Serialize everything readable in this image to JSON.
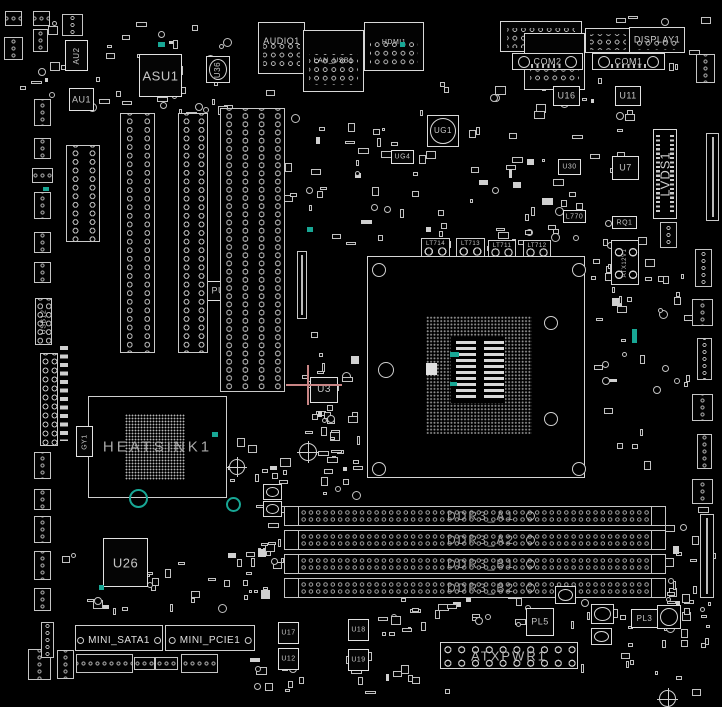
{
  "board": {
    "width": 722,
    "height": 707,
    "background": "#000000",
    "silkscreen_color": "#d6d6d6",
    "label_color": "#c4c4c4",
    "teal_accent": "#18a795",
    "crosshair_pink": "#c98585"
  },
  "components": [
    {
      "name": "audio1-connector",
      "label": "AUDIO1",
      "type": "io",
      "x": 258,
      "y": 22,
      "w": 47,
      "h": 52,
      "fs": 9,
      "labelTop": 14
    },
    {
      "name": "lan-usb1-connector",
      "label": "LAN_USB1",
      "type": "io",
      "x": 303,
      "y": 30,
      "w": 61,
      "h": 62,
      "fs": 7
    },
    {
      "name": "hdmi1-connector",
      "label": "HDMI1",
      "type": "io",
      "x": 364,
      "y": 22,
      "w": 60,
      "h": 49,
      "fs": 7,
      "labelTop": 16
    },
    {
      "name": "usb-stack-connector",
      "label": null,
      "type": "io",
      "x": 500,
      "y": 21,
      "w": 82,
      "h": 31
    },
    {
      "name": "lan-usb2-connector",
      "label": "LAN_USB2",
      "type": "io",
      "x": 524,
      "y": 33,
      "w": 61,
      "h": 57,
      "fs": 7
    },
    {
      "name": "io-connector-small",
      "label": null,
      "type": "io",
      "x": 585,
      "y": 28,
      "w": 46,
      "h": 25
    },
    {
      "name": "display1-connector",
      "label": "DISPLAY1",
      "type": "io",
      "x": 629,
      "y": 27,
      "w": 56,
      "h": 26,
      "fs": 9
    },
    {
      "name": "com2-port",
      "label": "COM2",
      "type": "com",
      "x": 512,
      "y": 53,
      "w": 71,
      "h": 17,
      "fs": 9
    },
    {
      "name": "com1-port",
      "label": "COM1",
      "type": "com",
      "x": 592,
      "y": 53,
      "w": 73,
      "h": 17,
      "fs": 9
    },
    {
      "name": "au2-chip",
      "label": "AU2",
      "type": "chip",
      "x": 65,
      "y": 40,
      "w": 23,
      "h": 31,
      "fs": 8,
      "vert": true
    },
    {
      "name": "asu1-chip",
      "label": "ASU1",
      "type": "chip",
      "x": 139,
      "y": 54,
      "w": 43,
      "h": 43,
      "fs": 13
    },
    {
      "name": "au1-chip",
      "label": "AU1",
      "type": "chip",
      "x": 69,
      "y": 88,
      "w": 25,
      "h": 23,
      "fs": 9
    },
    {
      "name": "u36-inductor",
      "label": "U36",
      "type": "ind",
      "x": 206,
      "y": 56,
      "w": 24,
      "h": 27,
      "fs": 8,
      "vert": true
    },
    {
      "name": "u16-chip",
      "label": "U16",
      "type": "chip",
      "x": 553,
      "y": 86,
      "w": 27,
      "h": 20,
      "fs": 9
    },
    {
      "name": "u11-chip",
      "label": "U11",
      "type": "chip",
      "x": 615,
      "y": 86,
      "w": 26,
      "h": 20,
      "fs": 9
    },
    {
      "name": "ug1-chip",
      "label": "UG1",
      "type": "ind",
      "x": 427,
      "y": 115,
      "w": 32,
      "h": 32,
      "fs": 8
    },
    {
      "name": "ug4-chip",
      "label": "UG4",
      "type": "chip",
      "x": 391,
      "y": 150,
      "w": 23,
      "h": 14,
      "fs": 7
    },
    {
      "name": "u7-chip",
      "label": "U7",
      "type": "chip",
      "x": 612,
      "y": 156,
      "w": 27,
      "h": 24,
      "fs": 9
    },
    {
      "name": "u30-chip",
      "label": "U30",
      "type": "chip",
      "x": 558,
      "y": 159,
      "w": 23,
      "h": 16,
      "fs": 7
    },
    {
      "name": "l770-chip",
      "label": "L770",
      "type": "chip",
      "x": 563,
      "y": 210,
      "w": 23,
      "h": 13,
      "fs": 7
    },
    {
      "name": "rq1-chip",
      "label": "RQ1",
      "type": "chip",
      "x": 612,
      "y": 216,
      "w": 25,
      "h": 13,
      "fs": 7
    },
    {
      "name": "lvds1-connector",
      "label": "LVDS1",
      "type": "lvds",
      "x": 653,
      "y": 129,
      "w": 24,
      "h": 90,
      "fs": 13,
      "vert": true
    },
    {
      "name": "atx12v1-connector",
      "label": "ATX12V1",
      "type": "atx4",
      "x": 611,
      "y": 240,
      "w": 28,
      "h": 45,
      "fs": 6,
      "vert": true
    },
    {
      "name": "lt714-pad",
      "label": "LT714",
      "type": "padchip",
      "x": 421,
      "y": 238,
      "w": 29,
      "h": 22,
      "fs": 6
    },
    {
      "name": "lt713-pad",
      "label": "LT713",
      "type": "padchip",
      "x": 456,
      "y": 238,
      "w": 29,
      "h": 22,
      "fs": 6
    },
    {
      "name": "lt711-pad",
      "label": "LT711",
      "type": "padchip",
      "x": 488,
      "y": 240,
      "w": 28,
      "h": 21,
      "fs": 6
    },
    {
      "name": "lt712-pad",
      "label": "LT712",
      "type": "padchip",
      "x": 523,
      "y": 240,
      "w": 28,
      "h": 21,
      "fs": 6
    },
    {
      "name": "cpu-socket",
      "label": null,
      "type": "socket",
      "x": 367,
      "y": 256,
      "w": 218,
      "h": 222,
      "pins": [
        58,
        59,
        106,
        118
      ],
      "center": [
        83,
        80,
        54,
        66
      ],
      "tab": [
        58,
        106,
        11,
        12
      ],
      "bars": [
        [
          88,
          84,
          20,
          58
        ],
        [
          116,
          84,
          20,
          58
        ]
      ],
      "teal": [
        [
          82,
          95,
          9,
          5
        ],
        [
          82,
          125,
          7,
          4
        ]
      ],
      "holes": [
        [
          10,
          12,
          6
        ],
        [
          210,
          12,
          6
        ],
        [
          10,
          211,
          6
        ],
        [
          210,
          211,
          6
        ],
        [
          17,
          112,
          7
        ],
        [
          182,
          65,
          6
        ],
        [
          182,
          161,
          6
        ]
      ]
    },
    {
      "name": "heatsink1",
      "label": "HEATSINK1",
      "type": "heatsink",
      "x": 88,
      "y": 396,
      "w": 139,
      "h": 102,
      "fs": 15,
      "bga": [
        36,
        17,
        60,
        66
      ]
    },
    {
      "name": "gy1-chip",
      "label": "GY1",
      "type": "chip",
      "x": 76,
      "y": 426,
      "w": 17,
      "h": 31,
      "fs": 7,
      "vert": true
    },
    {
      "name": "u3-chip",
      "label": "U3",
      "type": "chip",
      "x": 310,
      "y": 377,
      "w": 28,
      "h": 26,
      "fs": 10
    },
    {
      "name": "usb12-header",
      "label": "USB12",
      "type": "slotv",
      "x": 35,
      "y": 298,
      "w": 17,
      "h": 47,
      "fs": 7,
      "vert": true
    },
    {
      "name": "pu4-chip",
      "label": "PU4",
      "type": "chip",
      "x": 207,
      "y": 281,
      "w": 28,
      "h": 20,
      "fs": 9
    },
    {
      "name": "pin-slot-a",
      "label": null,
      "type": "slotv",
      "x": 66,
      "y": 145,
      "w": 34,
      "h": 97
    },
    {
      "name": "pin-slot-1",
      "label": null,
      "type": "slotv",
      "x": 120,
      "y": 113,
      "w": 35,
      "h": 240
    },
    {
      "name": "pin-slot-2",
      "label": null,
      "type": "slotv",
      "x": 178,
      "y": 113,
      "w": 30,
      "h": 240
    },
    {
      "name": "pin-slot-3",
      "label": null,
      "type": "slotv4",
      "x": 220,
      "y": 108,
      "w": 65,
      "h": 284
    },
    {
      "name": "edge-connector-thin",
      "label": null,
      "type": "thinv",
      "x": 297,
      "y": 251,
      "w": 10,
      "h": 68
    },
    {
      "name": "resistor-strip",
      "label": null,
      "type": "strip",
      "x": 60,
      "y": 346,
      "w": 8,
      "h": 95
    },
    {
      "name": "front-panel-header",
      "label": null,
      "type": "headerv2",
      "x": 40,
      "y": 353,
      "w": 18,
      "h": 93
    },
    {
      "name": "ddr3-a1-slot",
      "label": "DDR3_A1",
      "type": "dimm",
      "x": 284,
      "y": 506,
      "w": 382,
      "h": 20,
      "fs": 12
    },
    {
      "name": "ddr3-a2-slot",
      "label": "DDR3_A2",
      "type": "dimm",
      "x": 284,
      "y": 530,
      "w": 382,
      "h": 20,
      "fs": 12
    },
    {
      "name": "ddr3-b1-slot",
      "label": "DDR3_B1",
      "type": "dimm",
      "x": 284,
      "y": 554,
      "w": 382,
      "h": 20,
      "fs": 12
    },
    {
      "name": "ddr3-b2-slot",
      "label": "DDR3_B2",
      "type": "dimm",
      "x": 284,
      "y": 578,
      "w": 382,
      "h": 20,
      "fs": 12
    },
    {
      "name": "u26-chip",
      "label": "U26",
      "type": "chip",
      "x": 103,
      "y": 538,
      "w": 45,
      "h": 49,
      "fs": 13
    },
    {
      "name": "mini-sata1-slot",
      "label": "MINI_SATA1",
      "type": "mini",
      "x": 75,
      "y": 625,
      "w": 88,
      "h": 26,
      "fs": 10
    },
    {
      "name": "mini-pcie1-slot",
      "label": "MINI_PCIE1",
      "type": "mini",
      "x": 165,
      "y": 625,
      "w": 90,
      "h": 26,
      "fs": 10
    },
    {
      "name": "u17-chip",
      "label": "U17",
      "type": "chip",
      "x": 278,
      "y": 622,
      "w": 21,
      "h": 22,
      "fs": 7
    },
    {
      "name": "u12-chip",
      "label": "U12",
      "type": "chip",
      "x": 278,
      "y": 648,
      "w": 21,
      "h": 22,
      "fs": 7
    },
    {
      "name": "u18-chip",
      "label": "U18",
      "type": "chip",
      "x": 348,
      "y": 619,
      "w": 21,
      "h": 22,
      "fs": 7
    },
    {
      "name": "u19-chip",
      "label": "U19",
      "type": "chip",
      "x": 348,
      "y": 649,
      "w": 21,
      "h": 22,
      "fs": 7
    },
    {
      "name": "pl5-chip",
      "label": "PL5",
      "type": "chip",
      "x": 526,
      "y": 608,
      "w": 28,
      "h": 28,
      "fs": 9
    },
    {
      "name": "pl3-chip",
      "label": "PL3",
      "type": "chip",
      "x": 631,
      "y": 609,
      "w": 27,
      "h": 19,
      "fs": 8
    },
    {
      "name": "atxpwr1-connector",
      "label": "ATXPWR1",
      "type": "atx",
      "x": 440,
      "y": 642,
      "w": 138,
      "h": 27,
      "fs": 13
    },
    {
      "name": "inductor",
      "label": null,
      "type": "ind",
      "x": 263,
      "y": 484,
      "w": 19,
      "h": 16
    },
    {
      "name": "inductor",
      "label": null,
      "type": "ind",
      "x": 263,
      "y": 501,
      "w": 19,
      "h": 16
    },
    {
      "name": "inductor",
      "label": null,
      "type": "ind",
      "x": 591,
      "y": 604,
      "w": 23,
      "h": 20
    },
    {
      "name": "inductor",
      "label": null,
      "type": "ind",
      "x": 591,
      "y": 628,
      "w": 21,
      "h": 17
    },
    {
      "name": "inductor",
      "label": null,
      "type": "ind",
      "x": 555,
      "y": 586,
      "w": 21,
      "h": 18
    },
    {
      "name": "inductor",
      "label": null,
      "type": "ind",
      "x": 657,
      "y": 605,
      "w": 24,
      "h": 24
    },
    {
      "name": "pin-header",
      "label": null,
      "type": "header",
      "x": 34,
      "y": 99,
      "w": 17,
      "h": 27
    },
    {
      "name": "pin-header",
      "label": null,
      "type": "header",
      "x": 34,
      "y": 138,
      "w": 17,
      "h": 21
    },
    {
      "name": "pin-header",
      "label": null,
      "type": "header",
      "x": 32,
      "y": 168,
      "w": 21,
      "h": 15
    },
    {
      "name": "pin-header",
      "label": null,
      "type": "header",
      "x": 34,
      "y": 192,
      "w": 17,
      "h": 27
    },
    {
      "name": "pin-header",
      "label": null,
      "type": "header",
      "x": 34,
      "y": 232,
      "w": 17,
      "h": 21
    },
    {
      "name": "pin-header",
      "label": null,
      "type": "header",
      "x": 34,
      "y": 262,
      "w": 17,
      "h": 21
    },
    {
      "name": "pin-header",
      "label": null,
      "type": "header",
      "x": 34,
      "y": 452,
      "w": 17,
      "h": 27
    },
    {
      "name": "pin-header",
      "label": null,
      "type": "header",
      "x": 34,
      "y": 489,
      "w": 17,
      "h": 21
    },
    {
      "name": "pin-header",
      "label": null,
      "type": "header",
      "x": 34,
      "y": 516,
      "w": 17,
      "h": 27
    },
    {
      "name": "pin-header",
      "label": null,
      "type": "header",
      "x": 34,
      "y": 551,
      "w": 17,
      "h": 29
    },
    {
      "name": "pin-header",
      "label": null,
      "type": "header",
      "x": 34,
      "y": 588,
      "w": 17,
      "h": 23
    },
    {
      "name": "pin-header",
      "label": null,
      "type": "header",
      "x": 28,
      "y": 649,
      "w": 23,
      "h": 31
    },
    {
      "name": "pin-header",
      "label": null,
      "type": "header",
      "x": 57,
      "y": 650,
      "w": 17,
      "h": 29
    },
    {
      "name": "pin-header",
      "label": null,
      "type": "header",
      "x": 41,
      "y": 622,
      "w": 13,
      "h": 36
    },
    {
      "name": "pin-header",
      "label": null,
      "type": "header",
      "x": 5,
      "y": 11,
      "w": 17,
      "h": 15
    },
    {
      "name": "pin-header",
      "label": null,
      "type": "header",
      "x": 33,
      "y": 11,
      "w": 17,
      "h": 15
    },
    {
      "name": "pin-header",
      "label": null,
      "type": "header",
      "x": 4,
      "y": 37,
      "w": 19,
      "h": 23
    },
    {
      "name": "pin-header",
      "label": null,
      "type": "header",
      "x": 33,
      "y": 29,
      "w": 15,
      "h": 23
    },
    {
      "name": "pin-header",
      "label": null,
      "type": "header",
      "x": 62,
      "y": 14,
      "w": 21,
      "h": 22
    },
    {
      "name": "pin-header",
      "label": null,
      "type": "header",
      "x": 76,
      "y": 654,
      "w": 57,
      "h": 19
    },
    {
      "name": "pin-header",
      "label": null,
      "type": "header",
      "x": 134,
      "y": 657,
      "w": 21,
      "h": 13
    },
    {
      "name": "pin-header",
      "label": null,
      "type": "header",
      "x": 155,
      "y": 657,
      "w": 23,
      "h": 13
    },
    {
      "name": "pin-header",
      "label": null,
      "type": "header",
      "x": 181,
      "y": 654,
      "w": 37,
      "h": 19
    },
    {
      "name": "pin-header",
      "label": null,
      "type": "header",
      "x": 696,
      "y": 54,
      "w": 19,
      "h": 29
    },
    {
      "name": "pin-header",
      "label": null,
      "type": "header",
      "x": 660,
      "y": 222,
      "w": 17,
      "h": 26
    },
    {
      "name": "pin-header",
      "label": null,
      "type": "header",
      "x": 695,
      "y": 249,
      "w": 17,
      "h": 38
    },
    {
      "name": "pin-header",
      "label": null,
      "type": "header",
      "x": 692,
      "y": 299,
      "w": 21,
      "h": 27
    },
    {
      "name": "pin-header",
      "label": null,
      "type": "header",
      "x": 697,
      "y": 338,
      "w": 15,
      "h": 42
    },
    {
      "name": "pin-header",
      "label": null,
      "type": "header",
      "x": 692,
      "y": 394,
      "w": 21,
      "h": 27
    },
    {
      "name": "pin-header",
      "label": null,
      "type": "header",
      "x": 697,
      "y": 434,
      "w": 15,
      "h": 35
    },
    {
      "name": "pin-header",
      "label": null,
      "type": "header",
      "x": 692,
      "y": 479,
      "w": 21,
      "h": 25
    },
    {
      "name": "edge-connector-thin",
      "label": null,
      "type": "thinv",
      "x": 706,
      "y": 133,
      "w": 13,
      "h": 88
    },
    {
      "name": "edge-connector-thin",
      "label": null,
      "type": "thinv",
      "x": 700,
      "y": 514,
      "w": 14,
      "h": 84
    },
    {
      "name": "fiducial-mark",
      "label": null,
      "type": "fiducial",
      "x": 229,
      "y": 459,
      "w": 16,
      "h": 16
    },
    {
      "name": "fiducial-mark",
      "label": null,
      "type": "fiducial",
      "x": 299,
      "y": 443,
      "w": 18,
      "h": 18
    },
    {
      "name": "fiducial-mark",
      "label": null,
      "type": "fiducial",
      "x": 659,
      "y": 690,
      "w": 17,
      "h": 17
    },
    {
      "name": "teal-ring-marker",
      "label": null,
      "type": "ring-teal",
      "x": 129,
      "y": 489,
      "w": 19,
      "h": 19
    },
    {
      "name": "teal-ring-marker",
      "label": null,
      "type": "ring-teal",
      "x": 226,
      "y": 497,
      "w": 15,
      "h": 15
    },
    {
      "name": "teal-marker",
      "label": null,
      "type": "dot-teal",
      "x": 158,
      "y": 42,
      "w": 7,
      "h": 5
    },
    {
      "name": "teal-marker",
      "label": null,
      "type": "dot-teal",
      "x": 400,
      "y": 42,
      "w": 5,
      "h": 5
    },
    {
      "name": "teal-marker",
      "label": null,
      "type": "dot-teal",
      "x": 307,
      "y": 227,
      "w": 6,
      "h": 5
    },
    {
      "name": "teal-marker",
      "label": null,
      "type": "dot-teal",
      "x": 212,
      "y": 432,
      "w": 6,
      "h": 5
    },
    {
      "name": "teal-marker",
      "label": null,
      "type": "dot-teal",
      "x": 632,
      "y": 329,
      "w": 5,
      "h": 14
    },
    {
      "name": "teal-marker",
      "label": null,
      "type": "dot-teal",
      "x": 43,
      "y": 187,
      "w": 6,
      "h": 4
    },
    {
      "name": "teal-marker",
      "label": null,
      "type": "dot-teal",
      "x": 99,
      "y": 585,
      "w": 5,
      "h": 5
    },
    {
      "name": "target-crosshair",
      "label": null,
      "type": "cross",
      "x": 286,
      "y": 365,
      "w": 56,
      "h": 40,
      "hy": 19,
      "vx": 21
    }
  ]
}
